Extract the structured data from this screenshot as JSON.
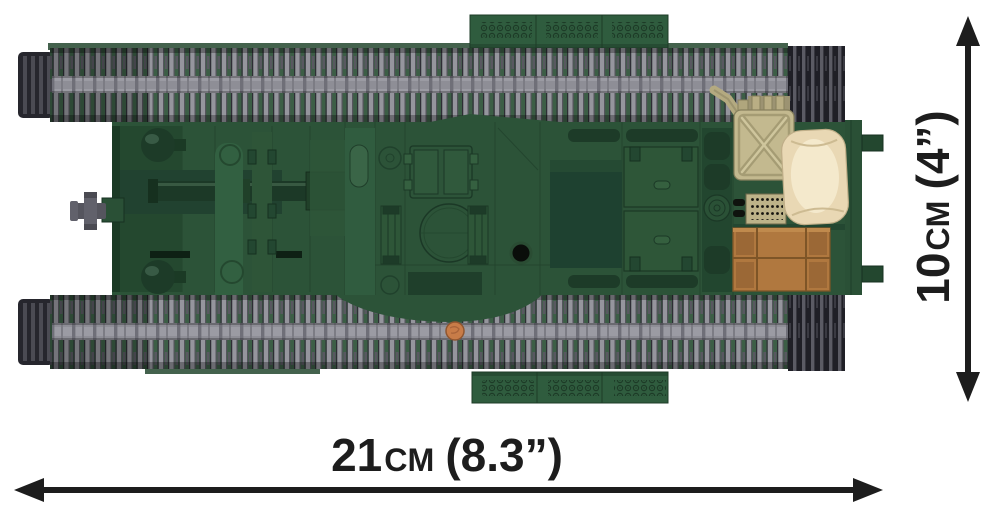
{
  "page": {
    "type": "product-dimension-diagram",
    "subject": "COBI building-block tank model, top view, with printed overall dimensions",
    "background": "#ffffff"
  },
  "dimensions": {
    "width": {
      "value": "21",
      "unit": "cm",
      "imperial": "(8.3”)"
    },
    "height": {
      "value": "10",
      "unit": "cm",
      "imperial": "(4”)"
    }
  },
  "colors": {
    "dimension_text": "#1d1d1d",
    "arrow": "#1d1d1d",
    "hull_green": "#2c5338",
    "hull_dark_green": "#1f3e2a",
    "track_light_grey": "#95959d",
    "track_dark_grey": "#2c2c33",
    "track_band_grey": "#8e8e96",
    "track_background_green": "#3c5e46",
    "jerrycan_khaki": "#c3b98f",
    "sandbag_cream": "#e9d8b4",
    "crate_brown": "#b0783f",
    "stud_orange": "#c87c48"
  }
}
